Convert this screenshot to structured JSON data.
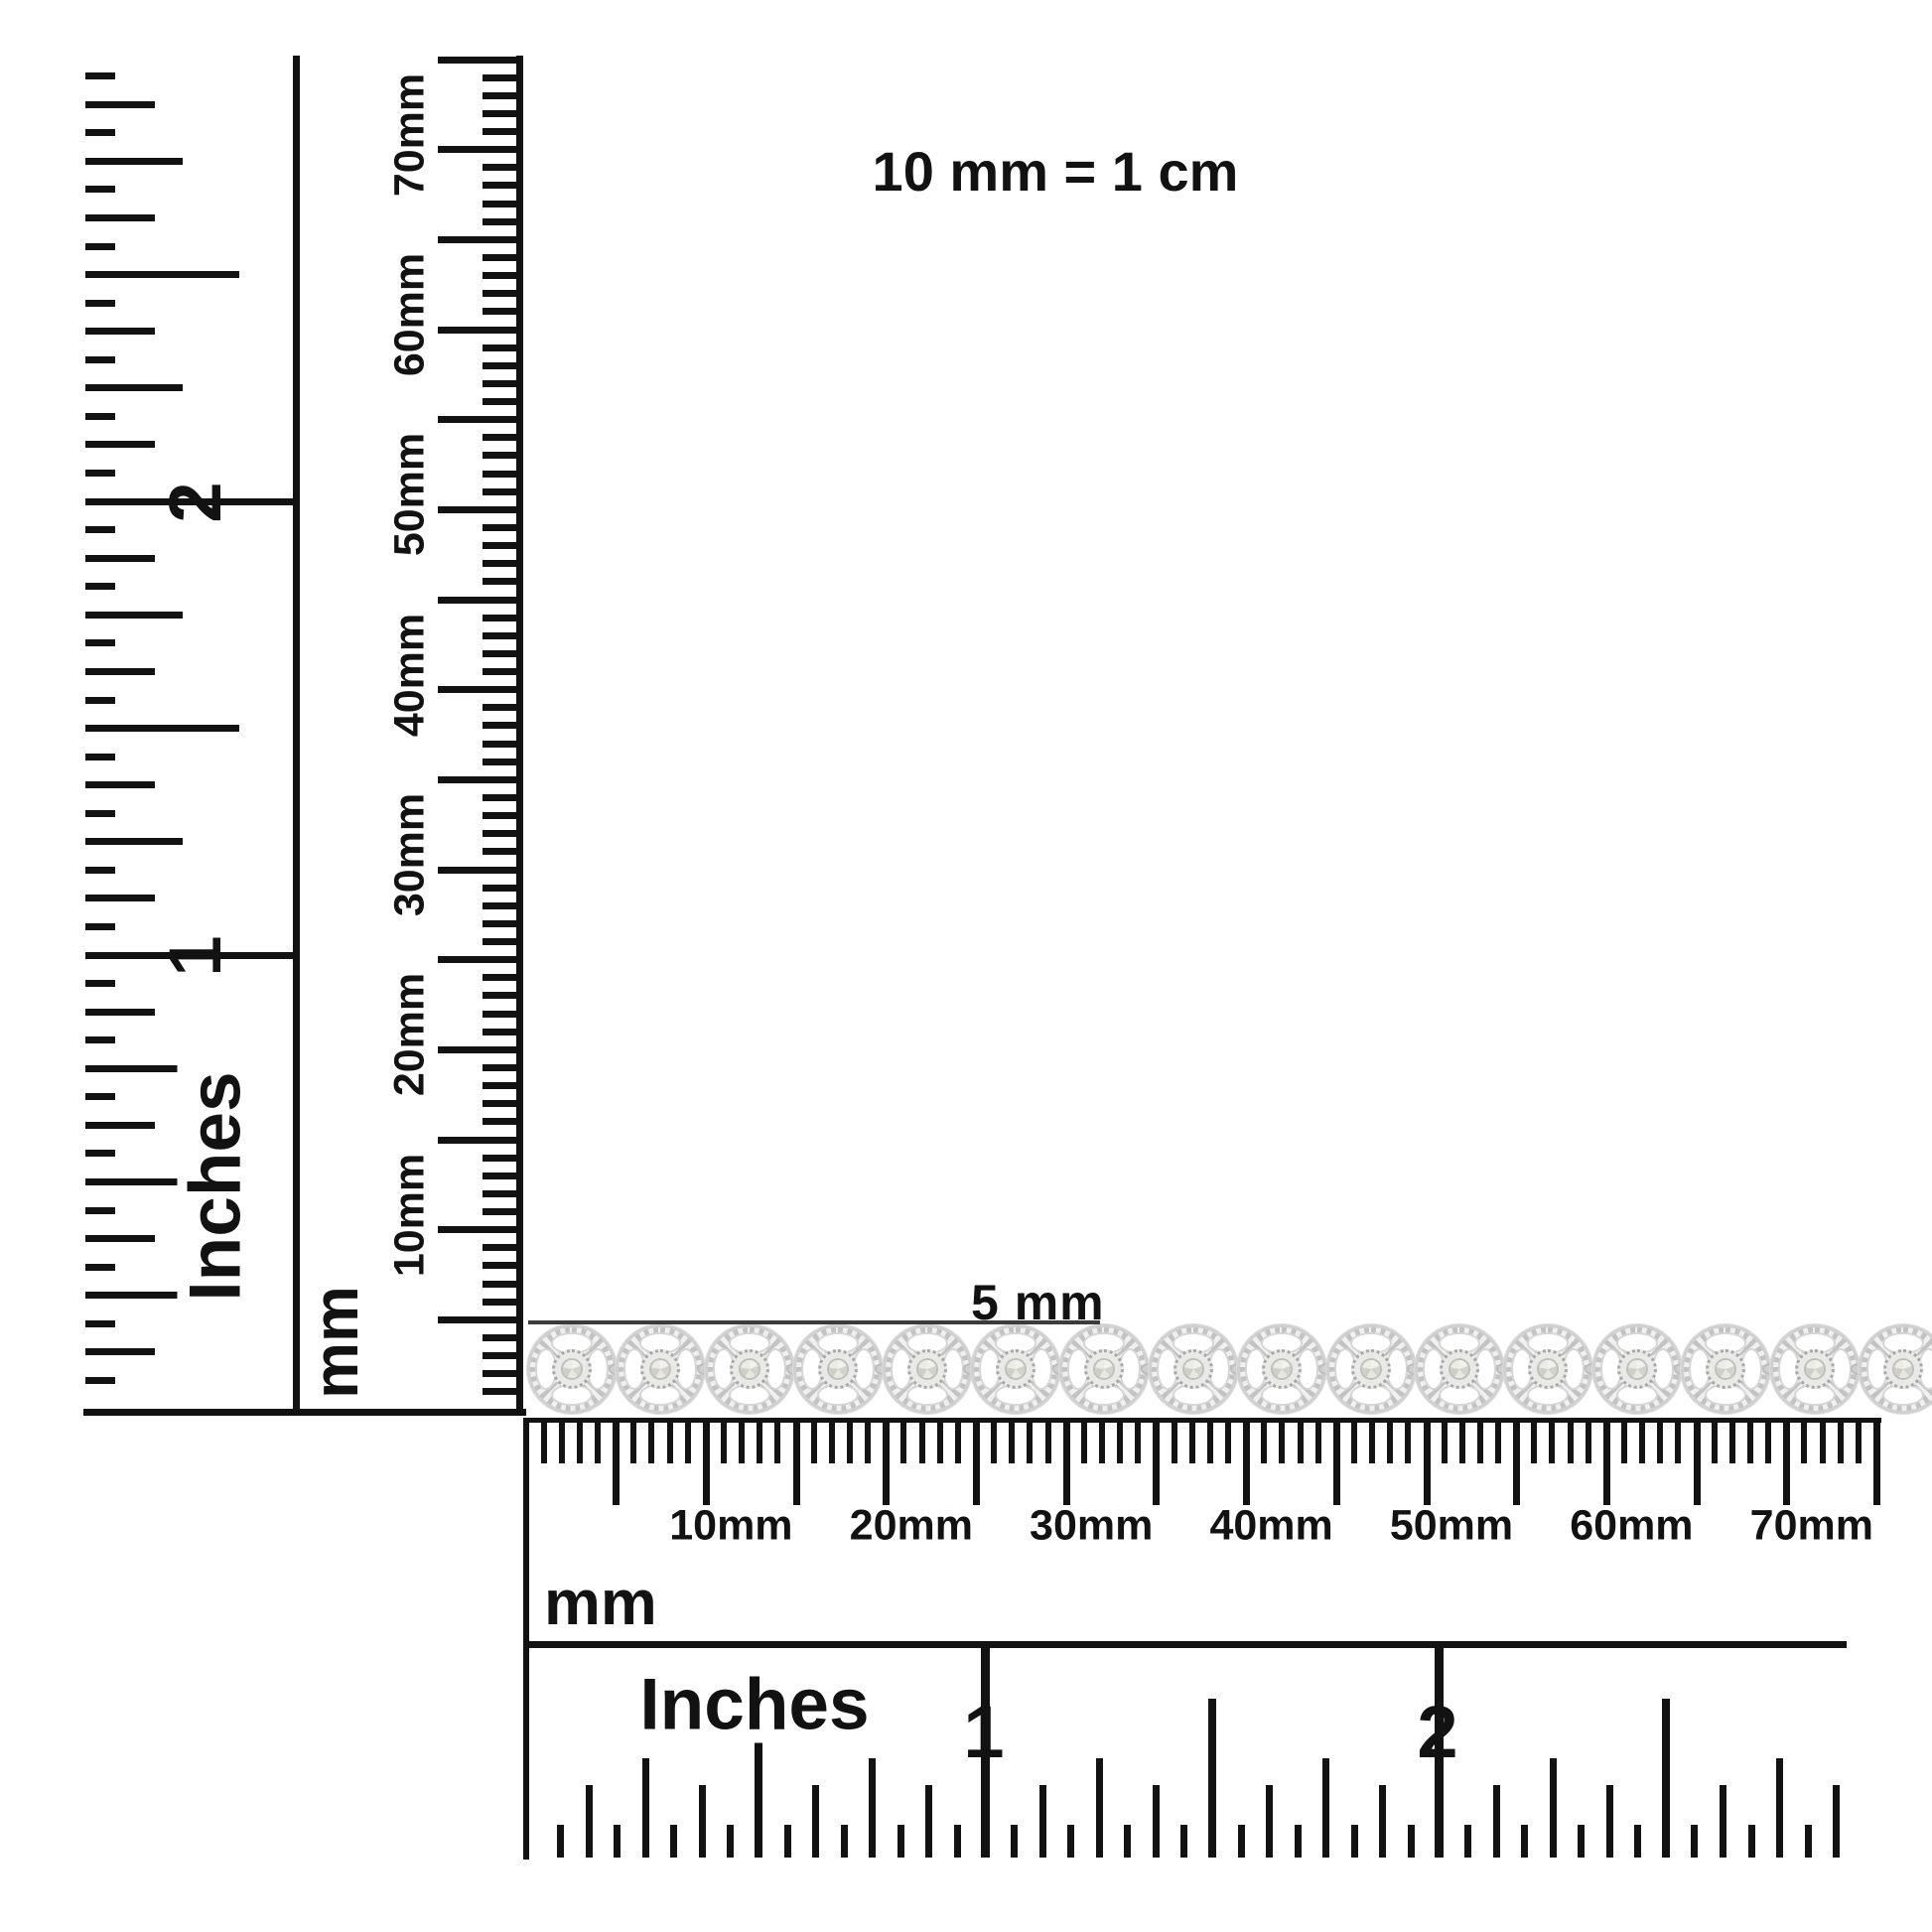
{
  "scale_note": "10 mm = 1 cm",
  "dimension_label": "5 mm",
  "left_inch_ruler": {
    "unit_label": "Inches",
    "numerals": [
      "1",
      "2"
    ]
  },
  "vertical_mm_ruler": {
    "unit_label": "mm",
    "labels": [
      "10mm",
      "20mm",
      "30mm",
      "40mm",
      "50mm",
      "60mm",
      "70mm"
    ]
  },
  "bottom_mm_ruler": {
    "unit_label": "mm",
    "labels": [
      "10mm",
      "20mm",
      "30mm",
      "40mm",
      "50mm",
      "60mm",
      "70mm"
    ]
  },
  "bottom_inch_ruler": {
    "unit_label": "Inches",
    "numerals": [
      "1",
      "2"
    ]
  },
  "bracelet": {
    "description": "silver circle-link bracelet with pave halo links and center diamonds",
    "link_count": 16,
    "stones_per_link": 1
  },
  "colors": {
    "ink": "#121212",
    "dimension_line": "#3c3c3c",
    "metal": "#d8d8d8",
    "metal_dark": "#b0b0b0",
    "stone": "#dcdcd6",
    "background": "#ffffff"
  }
}
